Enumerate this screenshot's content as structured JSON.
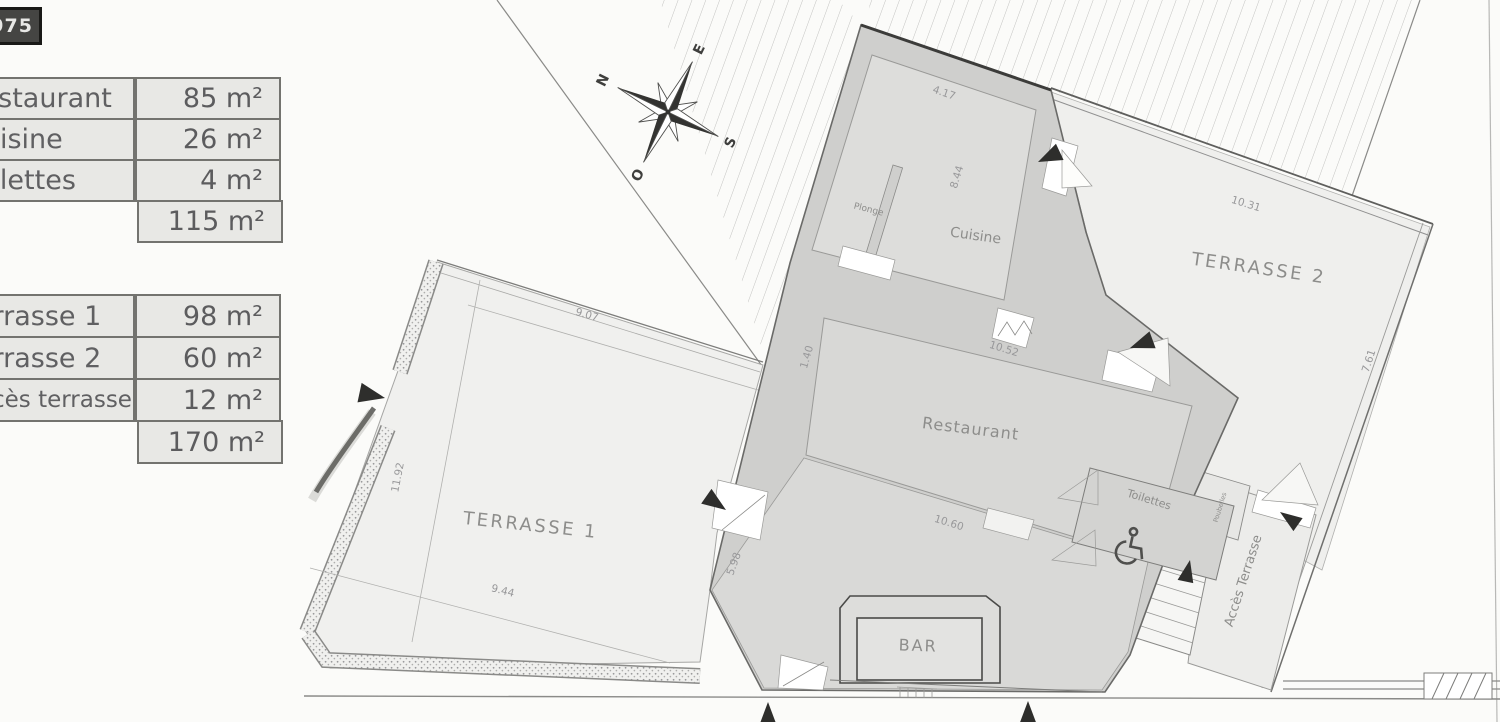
{
  "badge": {
    "text": "975"
  },
  "tables": {
    "interior": {
      "rows": [
        {
          "label": "Restaurant",
          "value": "85 m²"
        },
        {
          "label": "Cuisine",
          "value": "26 m²"
        },
        {
          "label": "Toilettes",
          "value": "4 m²"
        }
      ],
      "total": "115 m²"
    },
    "terrace": {
      "rows": [
        {
          "label": "Terrasse 1",
          "value": "98 m²"
        },
        {
          "label": "Terrasse 2",
          "value": "60 m²"
        },
        {
          "label": "Accès terrasse",
          "value": "12 m²"
        }
      ],
      "total": "170 m²"
    }
  },
  "compass": {
    "north": "N",
    "east": "E",
    "south": "S",
    "west": "O"
  },
  "plan": {
    "rooms": {
      "plonge": "Plonge",
      "cuisine": "Cuisine",
      "terrasse2": "TERRASSE 2",
      "restaurant": "Restaurant",
      "terrasse1": "TERRASSE 1",
      "bar": "BAR",
      "toilettes": "Toilettes",
      "acces_terrasse": "Accès Terrasse",
      "poubelles": "Poubelles"
    },
    "dimensions": {
      "kitchen_width": "4.17",
      "kitchen_depth": "8.44",
      "terrace2_top": "10.31",
      "terrace2_right": "7.61",
      "terrace1_top": "9.07",
      "terrace1_left": "11.92",
      "terrace1_bottom": "9.44",
      "restaurant_top": "10.52",
      "west_wall_upper": "1.40",
      "restaurant_bottom": "10.60",
      "west_wall_lower": "5.98"
    }
  }
}
